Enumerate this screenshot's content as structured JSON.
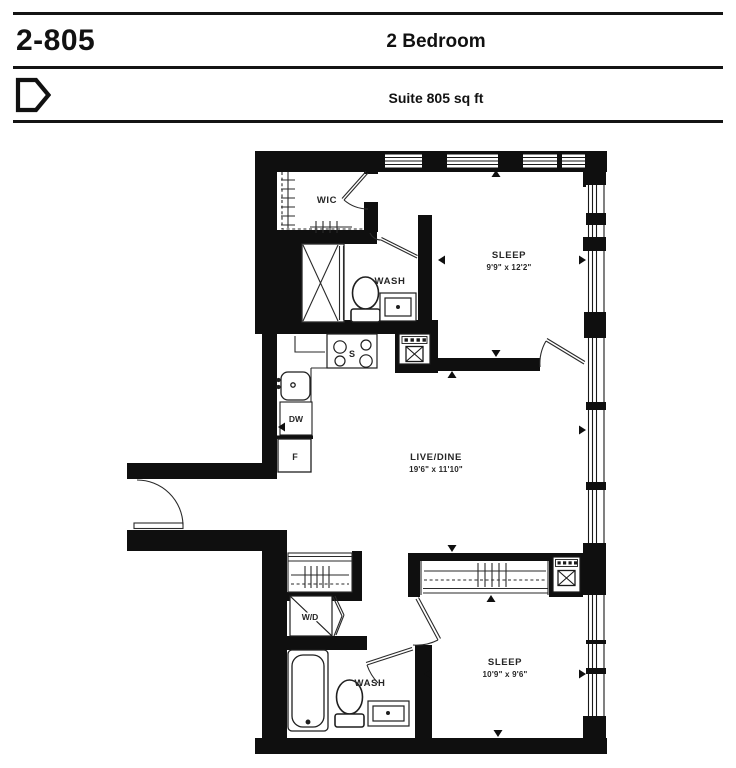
{
  "header": {
    "unit_number": "2-805",
    "unit_type": "2 Bedroom",
    "suite_area": "Suite 805 sq ft"
  },
  "floorplan": {
    "rooms": [
      {
        "id": "wic",
        "label": "WIC"
      },
      {
        "id": "wash-upper",
        "label": "WASH"
      },
      {
        "id": "sleep-1",
        "label": "SLEEP",
        "dimensions": "9'9\" x 12'2\""
      },
      {
        "id": "live-dine",
        "label": "LIVE/DINE",
        "dimensions": "19'6\" x 11'10\""
      },
      {
        "id": "wash-lower",
        "label": "WASH"
      },
      {
        "id": "sleep-2",
        "label": "SLEEP",
        "dimensions": "10'9\" x 9'6\""
      }
    ],
    "appliances": [
      {
        "id": "stove",
        "label": "S"
      },
      {
        "id": "dishwasher",
        "label": "DW"
      },
      {
        "id": "fridge",
        "label": "F"
      },
      {
        "id": "washer-dryer",
        "label": "W/D"
      }
    ]
  }
}
